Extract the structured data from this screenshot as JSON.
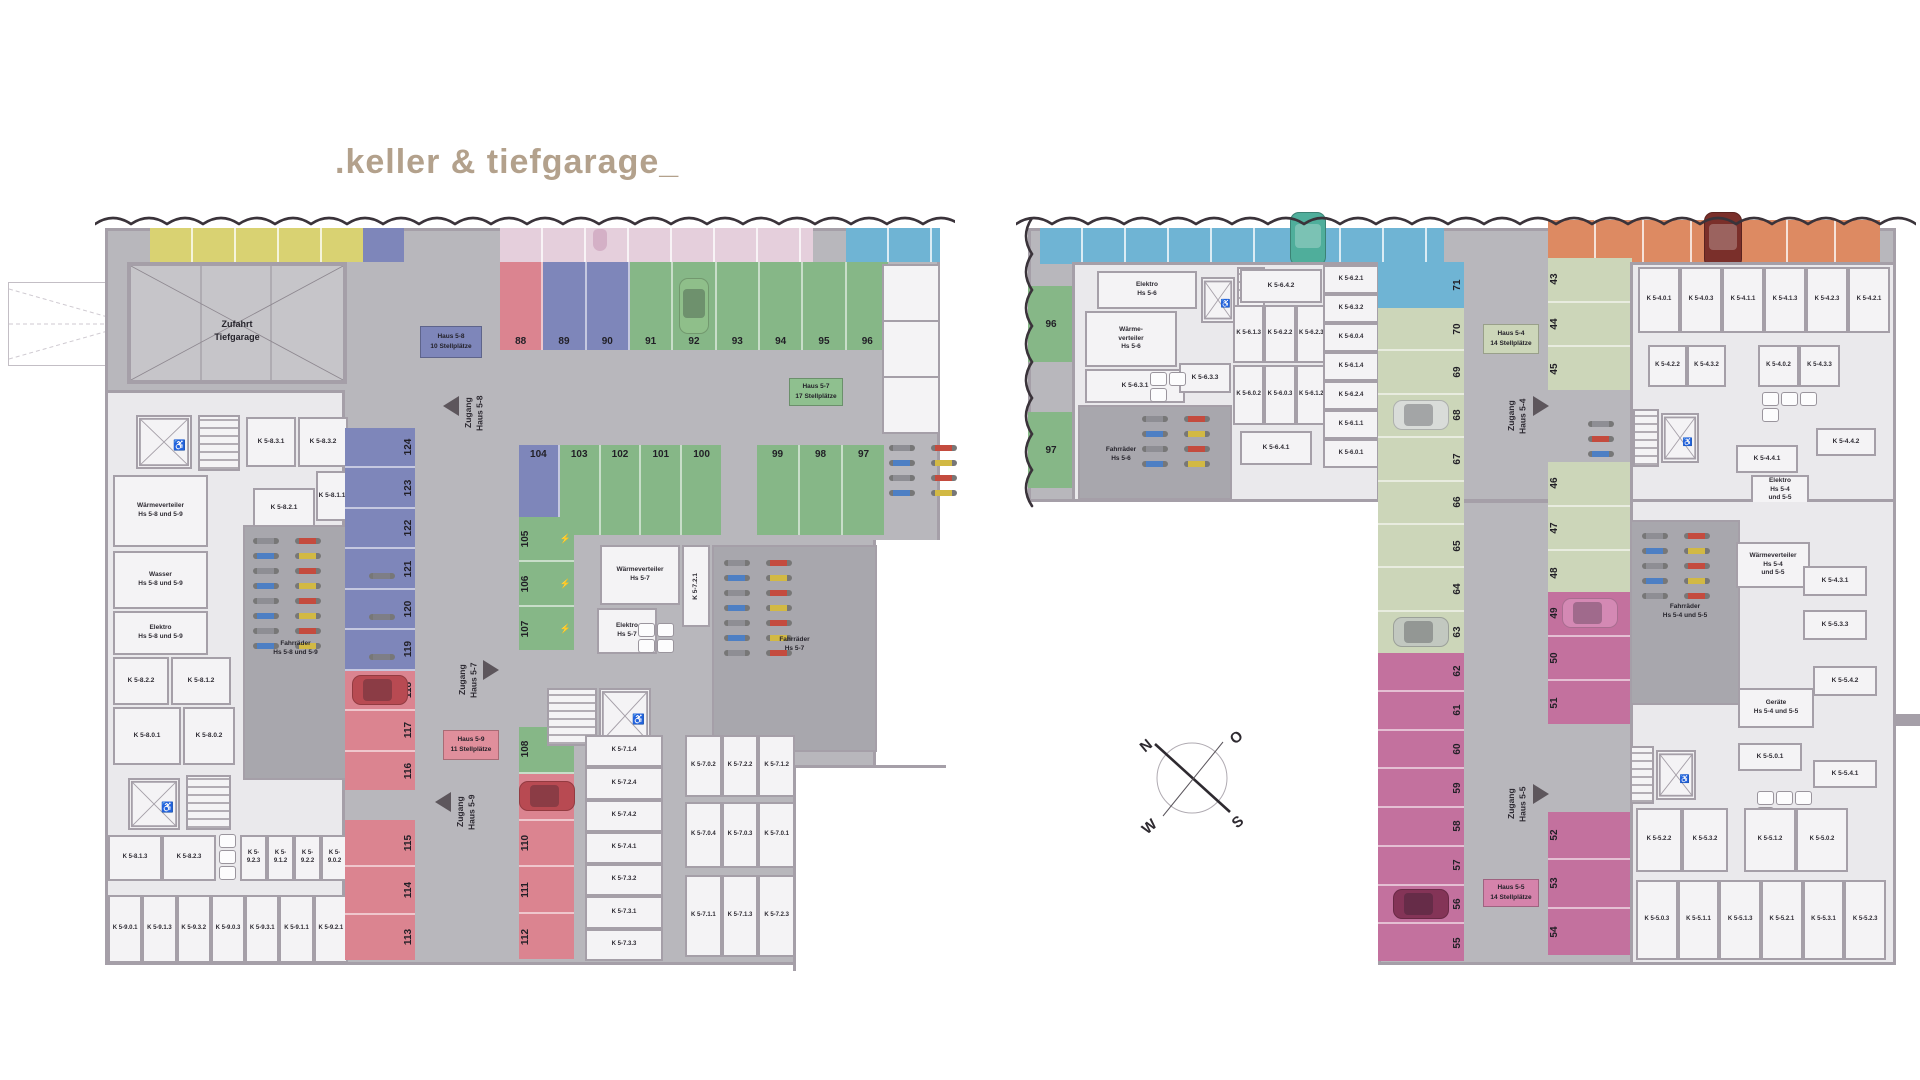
{
  "title": ".keller & tiefgarage_",
  "palette": {
    "green": "#86b787",
    "blue": "#7e86ba",
    "red": "#db8490",
    "pinkstrip": "#e5cfdc",
    "yellow": "#d9d272",
    "cyan": "#6fb4d4",
    "sage": "#ccd6b9",
    "magenta": "#c3719e",
    "orange": "#dd8a62",
    "base": "#b8b7bc",
    "cellar": "#eae9ec",
    "roomf": "#f4f3f5",
    "wall": "#a59fa8",
    "bikeroom": "#a8a7ad"
  },
  "compass": {
    "north": "N",
    "east": "O",
    "south": "S",
    "west": "W"
  },
  "left_plan": {
    "zufahrt_label": [
      "Zufahrt",
      "Tiefgarage"
    ],
    "haus58_label": [
      "Haus 5-8",
      "10 Stellplätze"
    ],
    "haus57_label": [
      "Haus 5-7",
      "17 Stellplätze"
    ],
    "haus59_label": [
      "Haus 5-9",
      "11 Stellplätze"
    ],
    "zugang58": [
      "Zugang",
      "Haus 5-8"
    ],
    "zugang57": [
      "Zugang",
      "Haus 5-7"
    ],
    "zugang59": [
      "Zugang",
      "Haus 5-9"
    ],
    "parking": {
      "row_top": [
        {
          "n": "88",
          "g": "red"
        },
        {
          "n": "89",
          "g": "blue"
        },
        {
          "n": "90",
          "g": "blue"
        },
        {
          "n": "91",
          "g": "green"
        },
        {
          "n": "92",
          "g": "green",
          "car": "#8fbf8a"
        },
        {
          "n": "93",
          "g": "green"
        },
        {
          "n": "94",
          "g": "green"
        },
        {
          "n": "95",
          "g": "green"
        },
        {
          "n": "96",
          "g": "green"
        }
      ],
      "row_mid_a": [
        {
          "n": "104",
          "g": "blue"
        },
        {
          "n": "103",
          "g": "green"
        },
        {
          "n": "102",
          "g": "green"
        },
        {
          "n": "101",
          "g": "green"
        },
        {
          "n": "100",
          "g": "green"
        }
      ],
      "row_mid_b": [
        {
          "n": "99",
          "g": "green"
        },
        {
          "n": "98",
          "g": "green"
        },
        {
          "n": "97",
          "g": "green"
        }
      ],
      "col_left_a": [
        {
          "n": "124",
          "g": "blue"
        },
        {
          "n": "123",
          "g": "blue"
        },
        {
          "n": "122",
          "g": "blue"
        },
        {
          "n": "121",
          "g": "blue",
          "icon": "bike"
        },
        {
          "n": "120",
          "g": "blue",
          "icon": "bike"
        },
        {
          "n": "119",
          "g": "blue",
          "icon": "bike"
        },
        {
          "n": "118",
          "g": "red",
          "car": "#b84a52"
        },
        {
          "n": "117",
          "g": "red"
        },
        {
          "n": "116",
          "g": "red"
        }
      ],
      "col_left_b": [
        {
          "n": "115",
          "g": "red"
        },
        {
          "n": "114",
          "g": "red"
        },
        {
          "n": "113",
          "g": "red"
        }
      ],
      "col_mid_a": [
        {
          "n": "105",
          "g": "green",
          "icon": "ev"
        },
        {
          "n": "106",
          "g": "green",
          "icon": "ev"
        },
        {
          "n": "107",
          "g": "green",
          "icon": "ev"
        }
      ],
      "col_mid_b": [
        {
          "n": "108",
          "g": "green"
        },
        {
          "n": "109",
          "g": "red",
          "car": "#b84a52"
        },
        {
          "n": "110",
          "g": "red"
        },
        {
          "n": "111",
          "g": "red"
        },
        {
          "n": "112",
          "g": "red"
        }
      ]
    },
    "rooms": {
      "waermeverteiler_89": [
        "Wärmeverteiler",
        "Hs 5-8 und 5-9"
      ],
      "wasser_89": [
        "Wasser",
        "Hs 5-8 und 5-9"
      ],
      "elektro_89": [
        "Elektro",
        "Hs 5-8 und 5-9"
      ],
      "fahrraeder_89": [
        "Fahrräder",
        "Hs 5-8 und 5-9"
      ],
      "k831": "K 5-8.3.1",
      "k832": "K 5-8.3.2",
      "k811": "K 5-8.1.1",
      "k821": "K 5-8.2.1",
      "k822": "K 5-8.2.2",
      "k812": "K 5-8.1.2",
      "k801": "K 5-8.0.1",
      "k802": "K 5-8.0.2",
      "row_bottom_a1": [
        "K 5-8.1.3",
        "K 5-8.2.3"
      ],
      "row_bottom_a2": [
        "K 5-9.2.3",
        "K 5-9.1.2",
        "K 5-9.2.2",
        "K 5-9.0.2"
      ],
      "row_bottom_b": [
        "K 5-9.0.1",
        "K 5-9.1.3",
        "K 5-9.3.2",
        "K 5-9.0.3",
        "K 5-9.3.1",
        "K 5-9.1.1",
        "K 5-9.2.1"
      ],
      "waermeverteiler_7": [
        "Wärmeverteiler",
        "Hs 5-7"
      ],
      "elektro_7": [
        "Elektro",
        "Hs 5-7"
      ],
      "fahrraeder_7": [
        "Fahrräder",
        "Hs 5-7"
      ],
      "k721": "K 5-7.2.1",
      "k7_column": [
        "K 5-7.1.4",
        "K 5-7.2.4",
        "K 5-7.4.2",
        "K 5-7.4.1",
        "K 5-7.3.2",
        "K 5-7.3.1",
        "K 5-7.3.3"
      ],
      "k7_grid_r1": [
        "K 5-7.0.2",
        "K 5-7.2.2",
        "K 5-7.1.2"
      ],
      "k7_grid_r2": [
        "K 5-7.0.4",
        "K 5-7.0.3",
        "K 5-7.0.1"
      ],
      "k7_grid_r3": [
        "K 5-7.1.1",
        "K 5-7.1.3",
        "K 5-7.2.3"
      ]
    }
  },
  "right_plan": {
    "seam_96": "96",
    "seam_97": "97",
    "haus54_label": [
      "Haus 5-4",
      "14 Stellplätze"
    ],
    "haus55_label": [
      "Haus 5-5",
      "14 Stellplätze"
    ],
    "zugang54": [
      "Zugang",
      "Haus 5-4"
    ],
    "zugang55": [
      "Zugang",
      "Haus 5-5"
    ],
    "parking": {
      "col_center_top": [
        {
          "n": "71",
          "g": "cyan"
        }
      ],
      "col_center_mid": [
        {
          "n": "70",
          "g": "sage"
        },
        {
          "n": "69",
          "g": "sage"
        },
        {
          "n": "68",
          "g": "sage",
          "car": "#d9dcd9"
        },
        {
          "n": "67",
          "g": "sage"
        },
        {
          "n": "66",
          "g": "sage"
        },
        {
          "n": "65",
          "g": "sage"
        },
        {
          "n": "64",
          "g": "sage"
        },
        {
          "n": "63",
          "g": "sage",
          "car": "#c2c8c0"
        }
      ],
      "col_center_bot": [
        {
          "n": "62",
          "g": "magenta"
        },
        {
          "n": "61",
          "g": "magenta"
        },
        {
          "n": "60",
          "g": "magenta"
        },
        {
          "n": "59",
          "g": "magenta"
        },
        {
          "n": "58",
          "g": "magenta"
        },
        {
          "n": "57",
          "g": "magenta"
        },
        {
          "n": "56",
          "g": "magenta",
          "car": "#843457"
        },
        {
          "n": "55",
          "g": "magenta"
        }
      ],
      "row_east_a": [
        {
          "n": "43",
          "g": "sage"
        },
        {
          "n": "44",
          "g": "sage"
        },
        {
          "n": "45",
          "g": "sage"
        }
      ],
      "row_east_b": [
        {
          "n": "46",
          "g": "sage"
        },
        {
          "n": "47",
          "g": "sage"
        },
        {
          "n": "48",
          "g": "sage"
        }
      ],
      "row_east_c": [
        {
          "n": "49",
          "g": "magenta",
          "car": "#d489b4"
        },
        {
          "n": "50",
          "g": "magenta"
        },
        {
          "n": "51",
          "g": "magenta"
        }
      ],
      "row_east_d": [
        {
          "n": "52",
          "g": "magenta"
        },
        {
          "n": "53",
          "g": "magenta"
        },
        {
          "n": "54",
          "g": "magenta"
        }
      ]
    },
    "rooms": {
      "elektro_6": [
        "Elektro",
        "Hs 5-6"
      ],
      "waermeverteiler_6": [
        "Wärme-",
        "verteiler",
        "Hs 5-6"
      ],
      "fahrraeder_6": [
        "Fahrräder",
        "Hs 5-6"
      ],
      "k631": "K 5-6.3.1",
      "k642": "K 5-6.4.2",
      "k633": "K 5-6.3.3",
      "k641": "K 5-6.4.1",
      "k6_row_a": [
        "K 5-6.1.3",
        "K 5-6.2.2",
        "K 5-6.2.3"
      ],
      "k6_row_b": [
        "K 5-6.0.2",
        "K 5-6.0.3",
        "K 5-6.1.2"
      ],
      "k6_column": [
        "K 5-6.2.1",
        "K 5-6.3.2",
        "K 5-6.0.4",
        "K 5-6.1.4",
        "K 5-6.2.4",
        "K 5-6.1.1",
        "K 5-6.0.1"
      ],
      "k4_row_top": [
        "K 5-4.0.1",
        "K 5-4.0.3",
        "K 5-4.1.1",
        "K 5-4.1.3",
        "K 5-4.2.3",
        "K 5-4.2.1"
      ],
      "k4_row2a": [
        "K 5-4.2.2",
        "K 5-4.3.2"
      ],
      "k4_row2b": [
        "K 5-4.0.2",
        "K 5-4.3.3"
      ],
      "k441": "K 5-4.4.1",
      "k442": "K 5-4.4.2",
      "k412": "K 5-4.1.2",
      "k431": "K 5-4.3.1",
      "elektro_45": [
        "Elektro",
        "Hs 5-4",
        "und 5-5"
      ],
      "waermeverteiler_45": [
        "Wärmeverteiler",
        "Hs 5-4",
        "und 5-5"
      ],
      "fahrraeder_45": [
        "Fahrräder",
        "Hs 5-4 und 5-5"
      ],
      "geraete_45": [
        "Geräte",
        "Hs 5-4 und 5-5"
      ],
      "k533": "K 5-5.3.3",
      "k542": "K 5-5.4.2",
      "k501": "K 5-5.0.1",
      "k541": "K 5-5.4.1",
      "k5_row_a1": [
        "K 5-5.2.2",
        "K 5-5.3.2"
      ],
      "k5_row_a2": [
        "K 5-5.1.2",
        "K 5-5.0.2"
      ],
      "k5_row_b": [
        "K 5-5.0.3",
        "K 5-5.1.1",
        "K 5-5.1.3",
        "K 5-5.2.1",
        "K 5-5.3.1",
        "K 5-5.2.3"
      ]
    }
  }
}
